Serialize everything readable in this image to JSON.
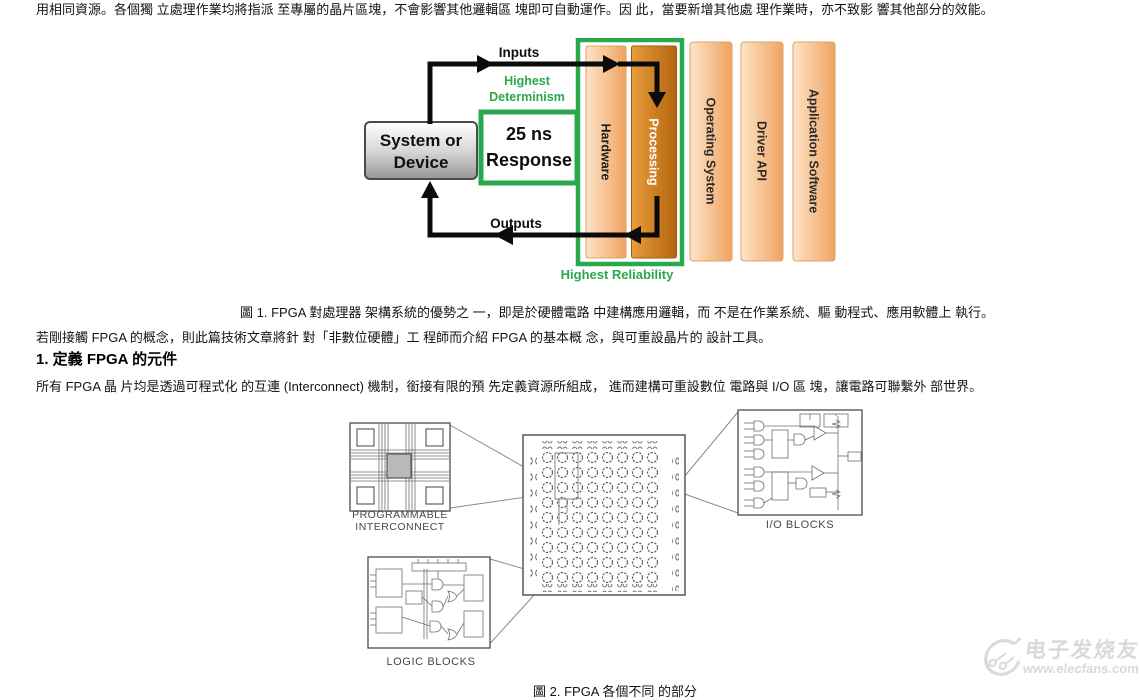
{
  "document": {
    "paragraph1": "用相同資源。各個獨 立處理作業均將指派 至專屬的晶片區塊，不會影響其他邏輯區 塊即可自動運作。因 此，當要新增其他處 理作業時，亦不致影 響其他部分的效能。",
    "figure1_caption": "圖 1. FPGA 對處理器 架構系統的優勢之 一，即是於硬體電路 中建構應用邏輯，而 不是在作業系統、驅 動程式、應用軟體上 執行。",
    "paragraph2": "若剛接觸 FPGA 的概念，則此篇技術文章將針 對「非數位硬體」工 程師而介紹 FPGA 的基本概 念，與可重設晶片的 設計工具。",
    "section_heading": "1. 定義 FPGA 的元件",
    "paragraph3": "所有 FPGA 晶 片均是透過可程式化 的互連 (Interconnect) 機制，銜接有限的預 先定義資源所組成， 進而建構可重設數位 電路與 I/O 區 塊，讓電路可聯繫外 部世界。",
    "figure2_caption": "圖 2. FPGA 各個不同 的部分"
  },
  "figure1": {
    "system_box": {
      "line1": "System or",
      "line2": "Device"
    },
    "response_box": {
      "line1": "25 ns",
      "line2": "Response"
    },
    "inputs_label": "Inputs",
    "outputs_label": "Outputs",
    "determinism_label": {
      "line1": "Highest",
      "line2": "Determinism"
    },
    "reliability_label": "Highest Reliability",
    "bars": [
      {
        "label": "Hardware"
      },
      {
        "label": "Processing"
      },
      {
        "label": "Operating System"
      },
      {
        "label": "Driver API"
      },
      {
        "label": "Application Software"
      }
    ],
    "colors": {
      "accent_green": "#2aa84c",
      "bar_light": "#f5b377",
      "bar_dark": "#c06c0e",
      "arrow_black": "#0b0b0b"
    }
  },
  "figure2": {
    "interconnect_label": {
      "line1": "PROGRAMMABLE",
      "line2": "INTERCONNECT"
    },
    "logic_label": "LOGIC BLOCKS",
    "io_label": "I/O BLOCKS"
  },
  "watermark": {
    "brand": "电子发烧友",
    "url": "www.elecfans.com"
  }
}
